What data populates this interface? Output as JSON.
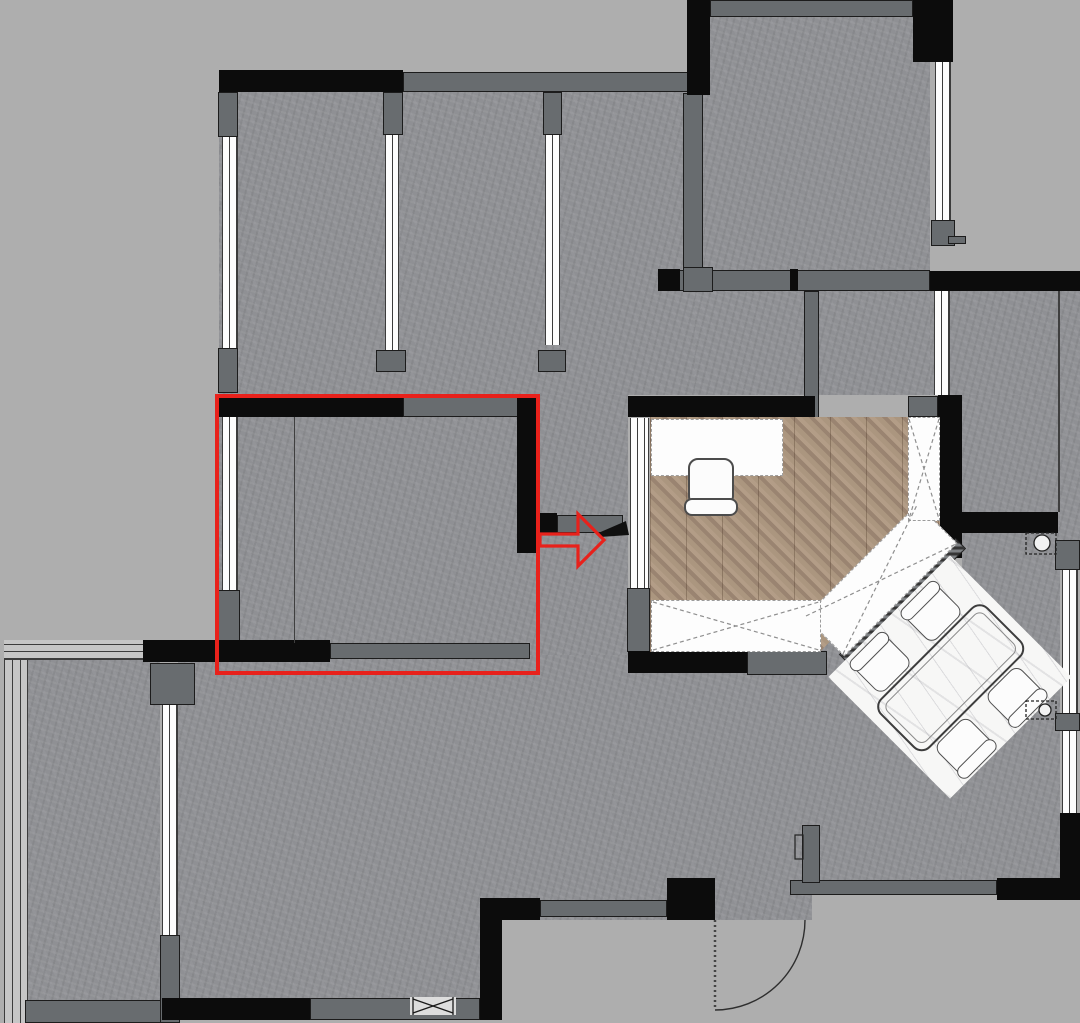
{
  "canvas": {
    "width": 1080,
    "height": 1023
  },
  "palette": {
    "outside": "#aeaeae",
    "floor": "#8f9094",
    "wall_black": "#0c0c0c",
    "wall_gray": "#686c6f",
    "window_line": "#3c3c3c",
    "wood_light": "#ab967f",
    "wood_dark": "#9a8471",
    "marble": "#f7f7f6",
    "highlight_red": "#e8211b",
    "furniture_outline": "#4c4c4c"
  },
  "plan": {
    "floors": [
      [
        219,
        92,
        486,
        303
      ],
      [
        219,
        395,
        321,
        280
      ],
      [
        705,
        17,
        225,
        275
      ],
      [
        695,
        292,
        235,
        103
      ],
      [
        930,
        291,
        130,
        104
      ],
      [
        540,
        395,
        88,
        285
      ],
      [
        178,
        655,
        634,
        345
      ],
      [
        628,
        675,
        432,
        205
      ],
      [
        962,
        395,
        98,
        485
      ],
      [
        820,
        640,
        142,
        40
      ],
      [
        28,
        658,
        132,
        344
      ],
      [
        1060,
        291,
        20,
        250
      ]
    ],
    "outside_patches": [
      [
        502,
        920,
        578,
        103
      ],
      [
        812,
        898,
        268,
        125
      ]
    ],
    "walls_gray": [
      [
        403,
        72,
        287,
        20
      ],
      [
        710,
        0,
        203,
        17
      ],
      [
        931,
        220,
        24,
        26
      ],
      [
        948,
        236,
        18,
        8
      ],
      [
        658,
        270,
        272,
        21
      ],
      [
        804,
        291,
        15,
        152
      ],
      [
        218,
        92,
        20,
        45
      ],
      [
        383,
        92,
        20,
        43
      ],
      [
        543,
        92,
        19,
        43
      ],
      [
        218,
        348,
        20,
        45
      ],
      [
        376,
        350,
        30,
        22
      ],
      [
        538,
        350,
        28,
        22
      ],
      [
        683,
        93,
        20,
        177
      ],
      [
        683,
        267,
        30,
        25
      ],
      [
        403,
        397,
        119,
        20
      ],
      [
        557,
        515,
        66,
        18
      ],
      [
        330,
        643,
        200,
        16
      ],
      [
        747,
        651,
        80,
        24
      ],
      [
        908,
        396,
        30,
        21
      ],
      [
        627,
        588,
        23,
        64
      ],
      [
        218,
        590,
        22,
        55
      ],
      [
        540,
        900,
        127,
        17
      ],
      [
        790,
        880,
        207,
        15
      ],
      [
        802,
        825,
        18,
        58
      ],
      [
        310,
        998,
        170,
        22
      ],
      [
        25,
        1000,
        140,
        23
      ],
      [
        160,
        935,
        20,
        88
      ],
      [
        150,
        663,
        45,
        42
      ],
      [
        1055,
        540,
        25,
        30
      ],
      [
        1055,
        713,
        25,
        18
      ],
      [
        957,
        515,
        28,
        18
      ]
    ],
    "walls_black": [
      [
        219,
        70,
        184,
        22
      ],
      [
        687,
        0,
        23,
        95
      ],
      [
        913,
        0,
        40,
        62
      ],
      [
        930,
        271,
        150,
        20
      ],
      [
        938,
        395,
        24,
        163
      ],
      [
        628,
        396,
        187,
        21
      ],
      [
        219,
        397,
        184,
        20
      ],
      [
        517,
        395,
        23,
        158
      ],
      [
        540,
        513,
        17,
        20
      ],
      [
        143,
        640,
        187,
        22
      ],
      [
        628,
        651,
        119,
        22
      ],
      [
        480,
        898,
        60,
        22
      ],
      [
        480,
        898,
        22,
        122
      ],
      [
        162,
        998,
        148,
        22
      ],
      [
        667,
        878,
        48,
        42
      ],
      [
        997,
        878,
        83,
        22
      ],
      [
        1060,
        813,
        20,
        67
      ],
      [
        962,
        512,
        96,
        21
      ],
      [
        658,
        269,
        22,
        22
      ],
      [
        790,
        269,
        8,
        22
      ]
    ],
    "windows": [
      {
        "x": 222,
        "y": 137,
        "w": 16,
        "h": 212,
        "t": "v"
      },
      {
        "x": 385,
        "y": 135,
        "w": 14,
        "h": 215,
        "t": "v"
      },
      {
        "x": 545,
        "y": 135,
        "w": 15,
        "h": 210,
        "t": "v"
      },
      {
        "x": 935,
        "y": 62,
        "w": 16,
        "h": 158,
        "t": "v"
      },
      {
        "x": 934,
        "y": 291,
        "w": 16,
        "h": 104,
        "t": "v"
      },
      {
        "x": 630,
        "y": 418,
        "w": 19,
        "h": 170,
        "t": "v"
      },
      {
        "x": 222,
        "y": 417,
        "w": 16,
        "h": 173,
        "t": "v"
      },
      {
        "x": 1062,
        "y": 570,
        "w": 16,
        "h": 143,
        "t": "v"
      },
      {
        "x": 1062,
        "y": 731,
        "w": 15,
        "h": 82,
        "t": "v"
      },
      {
        "x": 4,
        "y": 640,
        "w": 24,
        "h": 383,
        "t": "vw"
      },
      {
        "x": 4,
        "y": 640,
        "w": 140,
        "h": 20,
        "t": "h"
      },
      {
        "x": 162,
        "y": 700,
        "w": 16,
        "h": 235,
        "t": "v"
      }
    ],
    "divider_lines": [
      [
        294,
        417,
        1,
        226
      ],
      [
        1058,
        291,
        2,
        221
      ]
    ]
  },
  "annotation": {
    "highlight_rect": {
      "x": 215,
      "y": 394,
      "w": 325,
      "h": 281
    },
    "arrow": {
      "from_x": 540,
      "tip_x": 604,
      "y": 540,
      "direction": "right"
    }
  },
  "study_room": {
    "floor": "herringbone-wood",
    "furniture": [
      "desk",
      "desk-chair",
      "wardrobe-right",
      "wardrobe-diagonal",
      "wardrobe-bottom"
    ]
  },
  "dining_area": {
    "floor": "marble",
    "rotation_deg": 45,
    "table_count": 1,
    "chair_count": 4
  },
  "kitchen": {
    "hob_symbols": 2
  },
  "doors": {
    "entry_swing_door": {
      "hinge_x": 715,
      "hinge_y": 920,
      "radius": 90
    },
    "study_door_leaf": true
  }
}
